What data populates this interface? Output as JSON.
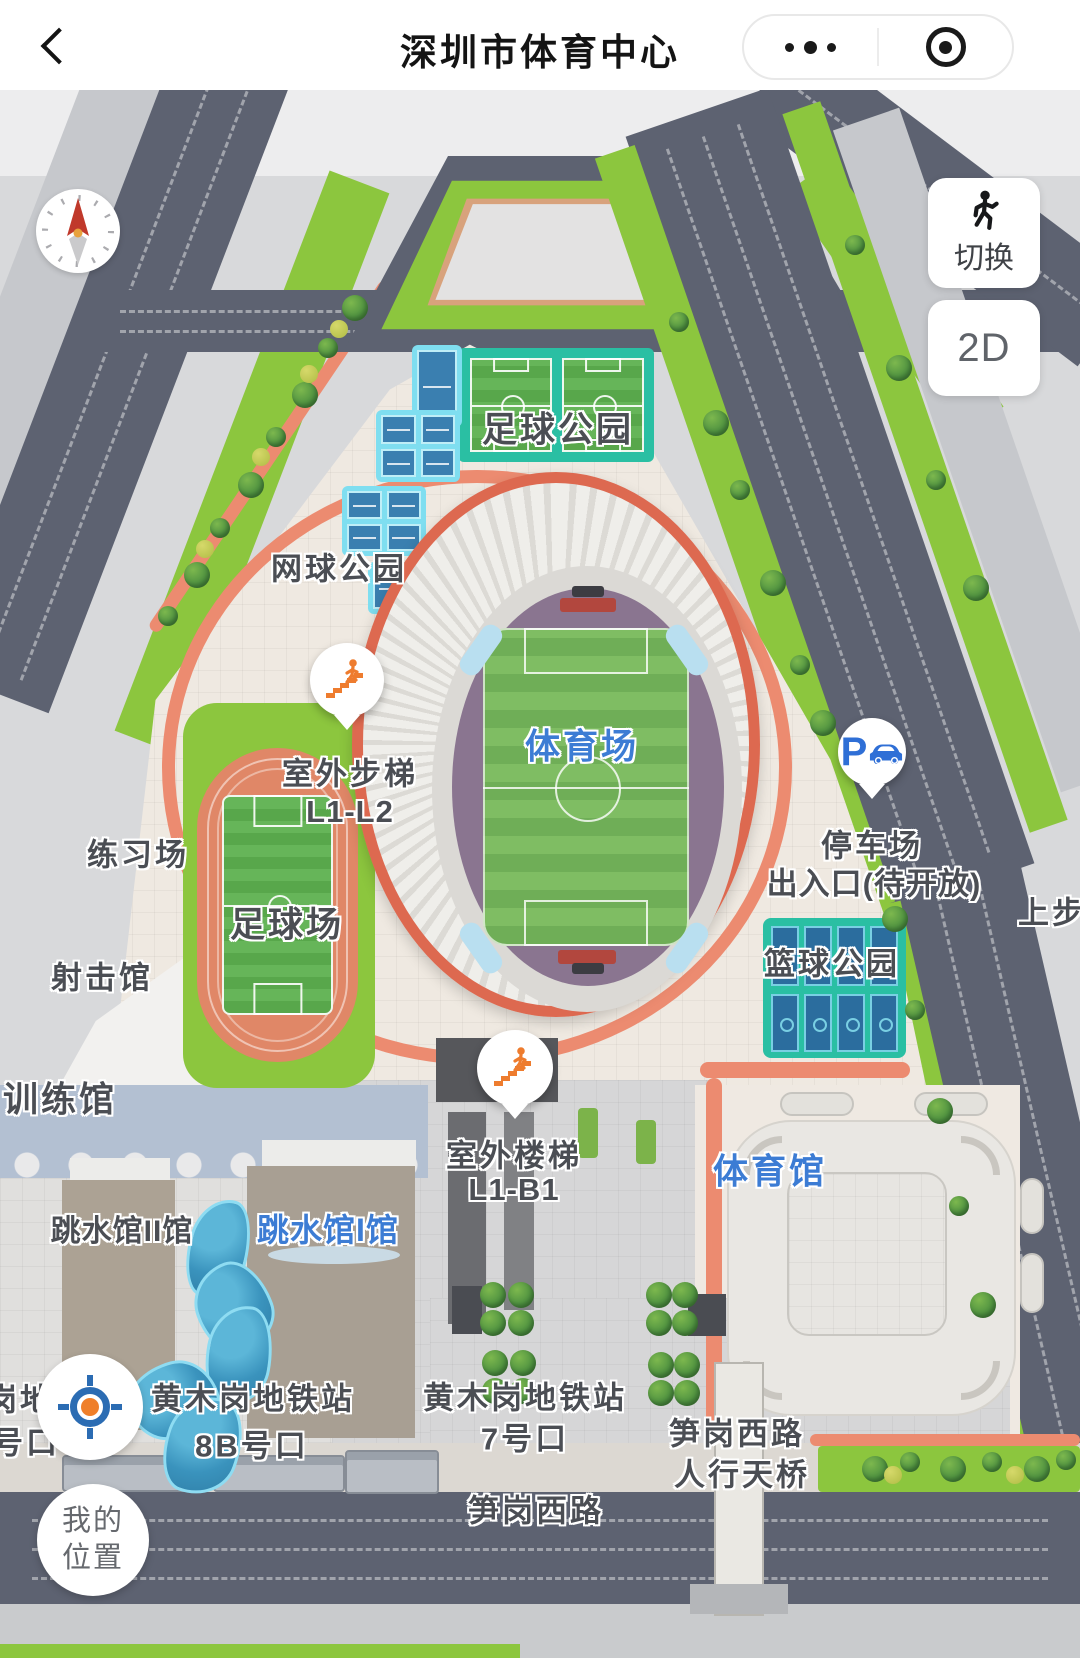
{
  "header": {
    "title": "深圳市体育中心"
  },
  "capsule": {
    "more": "•••"
  },
  "controls": {
    "switch": {
      "label": "切换",
      "icon": "walking-person-icon"
    },
    "view_mode": {
      "label": "2D"
    },
    "my_location": {
      "line1": "我的",
      "line2": "位置",
      "icon": "location-crosshair-icon"
    },
    "compass": {
      "icon": "compass-north-icon"
    }
  },
  "places": {
    "football_park": "足球公园",
    "tennis_park": "网球公园",
    "stadium": "体育场",
    "practice_field": "练习场",
    "football_field": "足球场",
    "shooting_hall": "射击馆",
    "training_hall": "训练馆",
    "basketball_park": "篮球公园",
    "gymnasium": "体育馆",
    "diving_hall_ii": "跳水馆II馆",
    "diving_hall_i": "跳水馆I馆"
  },
  "markers": {
    "outdoor_steps": {
      "line1": "室外步梯",
      "line2": "L1-L2",
      "icon": "stairs-person-icon"
    },
    "outdoor_stairs": {
      "line1": "室外楼梯",
      "line2": "L1-B1",
      "icon": "stairs-person-icon"
    },
    "parking": {
      "line1": "停车场",
      "line2": "出入口(待开放)",
      "icon_letter": "P",
      "icon": "parking-car-icon"
    }
  },
  "transit": {
    "metro_8b": {
      "line1": "黄木岗地铁站",
      "line2": "8B号口"
    },
    "metro_7": {
      "line1": "黄木岗地铁站",
      "line2": "7号口"
    },
    "road_sungang": "笋岗西路",
    "footbridge": {
      "line1": "笋岗西路",
      "line2": "人行天桥"
    },
    "road_shangbu_partial": "上步路",
    "edge_partial": {
      "line1": "岗地",
      "line2": "号口"
    }
  },
  "colors": {
    "label_dark": "#4b4e54",
    "label_blue": "#3c7cd4",
    "marker_orange": "#ee7c2e",
    "marker_blue": "#2f6fd6",
    "teal": "#2abfa3",
    "court_blue": "#3a7fb0",
    "salmon": "#ec8b70",
    "road_dark": "#5d6271",
    "grass_green": "#8cc63e",
    "stadium_ring_red": "#dd6950",
    "stands_purple": "#8a7590"
  }
}
